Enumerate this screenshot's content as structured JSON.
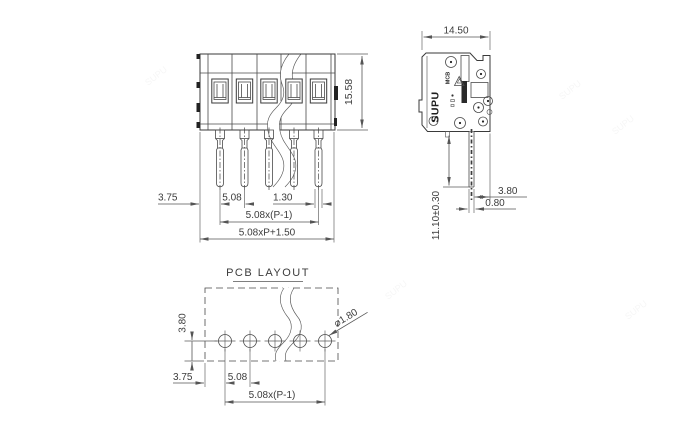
{
  "watermark_text": "SUPU",
  "front_view": {
    "dim_height": "15.58",
    "dim_lead_offset": "3.75",
    "dim_pitch": "5.08",
    "dim_pin_width": "1.30",
    "dim_span": "5.08x(P-1)",
    "dim_total_width": "5.08xP+1.50"
  },
  "side_view": {
    "dim_width": "14.50",
    "dim_rear_offset": "3.80",
    "dim_pin_thickness": "0.80",
    "dim_pin_length": "11.10±0.30",
    "marking_brand": "SUPU",
    "marking_series": "MCB"
  },
  "pcb_layout": {
    "title": "PCB LAYOUT",
    "dim_row_offset": "3.80",
    "dim_edge_offset": "3.75",
    "dim_pitch": "5.08",
    "dim_span": "5.08x(P-1)",
    "dim_hole_diameter": "⌀1.80"
  }
}
